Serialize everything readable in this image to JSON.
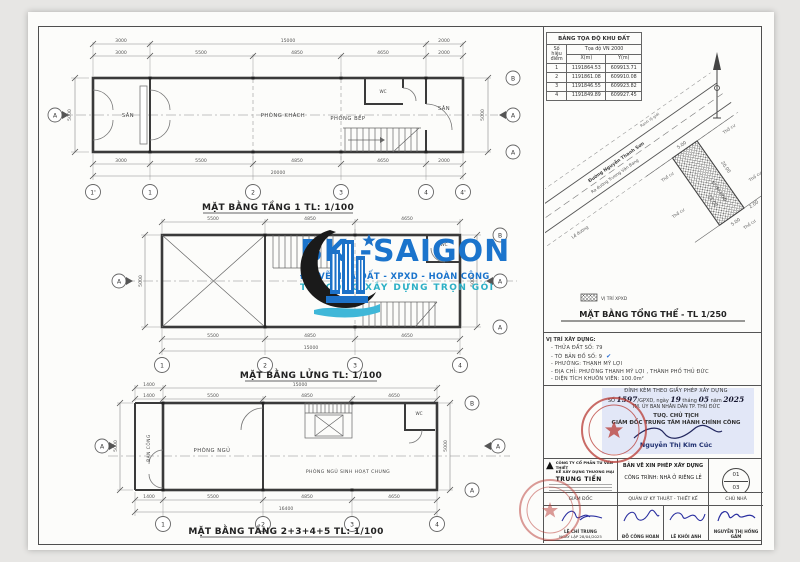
{
  "colors": {
    "sheet_bg": "#fcfcfa",
    "page_bg": "#e7e6e4",
    "line": "#4f4f4f",
    "logo_blue": "#1b74cc",
    "logo_teal": "#2cb0c6",
    "stamp_red": "#b93b35",
    "highlight_blue": "#dde3f6",
    "ink_blue": "#2a2fa0"
  },
  "plan1": {
    "title": "MẶT BẰNG TẦNG 1 TL: 1/100",
    "rooms": {
      "san1": "SÂN",
      "khach": "PHÒNG KHÁCH",
      "bep": "PHÒNG BẾP",
      "wc": "WC",
      "san2": "SÂN"
    },
    "top1": [
      "3000",
      "15000",
      "2000"
    ],
    "top2": [
      "3000",
      "5500",
      "4850",
      "4650",
      "2000"
    ],
    "bot1": [
      "3000",
      "5500",
      "4850",
      "4650",
      "2000"
    ],
    "total": "20000",
    "left": "5000",
    "right": "5000",
    "cols": [
      "1'",
      "1",
      "2",
      "3",
      "4",
      "4'"
    ],
    "gB": "B",
    "gA": "A",
    "sec": "A"
  },
  "plan2": {
    "title": "MẶT BẰNG LỬNG TL: 1/100",
    "wc": "WC",
    "top": [
      "5500",
      "4850",
      "4650"
    ],
    "bot": [
      "5500",
      "4850",
      "4650"
    ],
    "total": "15000",
    "left": "5000",
    "right": "5000",
    "cols": [
      "1",
      "2",
      "3",
      "4"
    ],
    "gB": "B",
    "gA": "A",
    "sec": "A"
  },
  "plan3": {
    "title": "MẶT BẰNG TẦNG 2+3+4+5 TL: 1/100",
    "rooms": {
      "bancong": "BAN CÔNG",
      "ngu": "PHÒNG NGỦ",
      "chung": "PHÒNG NGỦ SINH HOẠT CHUNG",
      "wc": "WC"
    },
    "top1": [
      "1400",
      "15000"
    ],
    "top2": [
      "1400",
      "5500",
      "4850",
      "4650"
    ],
    "bot": [
      "1400",
      "5500",
      "4850",
      "4650"
    ],
    "total": "16400",
    "left": "5000",
    "right": "5000",
    "cols": [
      "1",
      "2",
      "3",
      "4"
    ],
    "gB": "B",
    "gA": "A",
    "sec": "A"
  },
  "site": {
    "le": "Lề đường",
    "street1": "Đường Nguyễn Thanh Sơn",
    "street2": "Ra đường Trương Văn Bang",
    "ranh": "Ranh lộ giới",
    "tc": "Thổ cư",
    "plot": "VỊ TRÍ XPXD",
    "d": [
      "5.00",
      "20.00",
      "13.00",
      "5.00",
      "2.00"
    ],
    "legend": "VỊ TRÍ XPXD",
    "title": "MẶT BẰNG TỔNG THỂ - TL 1/250"
  },
  "coord": {
    "title": "BẢNG TỌA ĐỘ KHU ĐẤT",
    "group": "Tọa độ VN 2000",
    "col_point": "Số hiệu điểm",
    "col_x": "X(m)",
    "col_y": "Y(m)",
    "rows": [
      {
        "n": "1",
        "x": "1191864.53",
        "y": "609913.71"
      },
      {
        "n": "2",
        "x": "1191861.08",
        "y": "609910.08"
      },
      {
        "n": "3",
        "x": "1191846.55",
        "y": "609923.82"
      },
      {
        "n": "4",
        "x": "1191849.89",
        "y": "609927.45"
      }
    ]
  },
  "loc": {
    "heading": "VỊ TRÍ XÂY DỰNG:",
    "lines": [
      "- THỬA ĐẤT SỐ:  79",
      "- TỜ BẢN ĐỒ SỐ:  9",
      "- PHƯỜNG:  THẠNH MỸ LỢI",
      "- ĐỊA CHỈ:  PHƯỜNG THẠNH MỸ LỢI , THÀNH PHỐ THỦ ĐỨC",
      "- DIỆN TÍCH KHUÔN VIÊN:  100.0m²"
    ],
    "check": "✔"
  },
  "permit": {
    "l1": "ĐÍNH KÈM THEO GIẤY PHÉP XÂY DỰNG",
    "f1": "SỐ",
    "num": "1597",
    "f2": "/GPXD, ngày",
    "day": "19",
    "f3": "tháng",
    "month": "05",
    "f4": "năm",
    "year": "2025",
    "l3": "TM. ỦY BAN NHÂN DÂN TP. THỦ ĐỨC",
    "l4": "TUQ. CHỦ TỊCH",
    "l5": "GIÁM ĐỐC TRUNG TÂM HÀNH CHÍNH CÔNG",
    "signer": "Nguyễn Thị Kim Cúc"
  },
  "tb": {
    "company": [
      "CÔNG TY CỔ PHẦN TƯ VẤN THIẾT",
      "KẾ XÂY DỰNG THƯƠNG MẠI",
      "TRUNG TIẾN"
    ],
    "doc_type": "BẢN VẼ XIN PHÉP XÂY DỰNG",
    "project": "CÔNG TRÌNH: NHÀ Ở RIÊNG LẺ",
    "sheet_no": "01",
    "sheet_total": "03",
    "roles": [
      "GIÁM ĐỐC",
      "QUẢN LÝ KỸ THUẬT - THIẾT KẾ",
      "CHỦ NHÀ"
    ],
    "sig1_name": "LÊ CHÍ TRUNG",
    "sig1_date": "NGÀY LẬP 28/04/2025",
    "sig2_name": "ĐỖ CÔNG HOAN",
    "sig3_name": "LÊ KHÔI ANH",
    "sig4_name": "NGUYỄN THỊ HỒNG GẤM"
  },
  "logo": {
    "title": "BK -SAIGON",
    "tag1": "ĐO VẼ NHÀ ĐẤT - XPXD - HOÀN CÔNG",
    "tag2": "THI CÔNG XÂY DỰNG TRỌN GÓI"
  }
}
